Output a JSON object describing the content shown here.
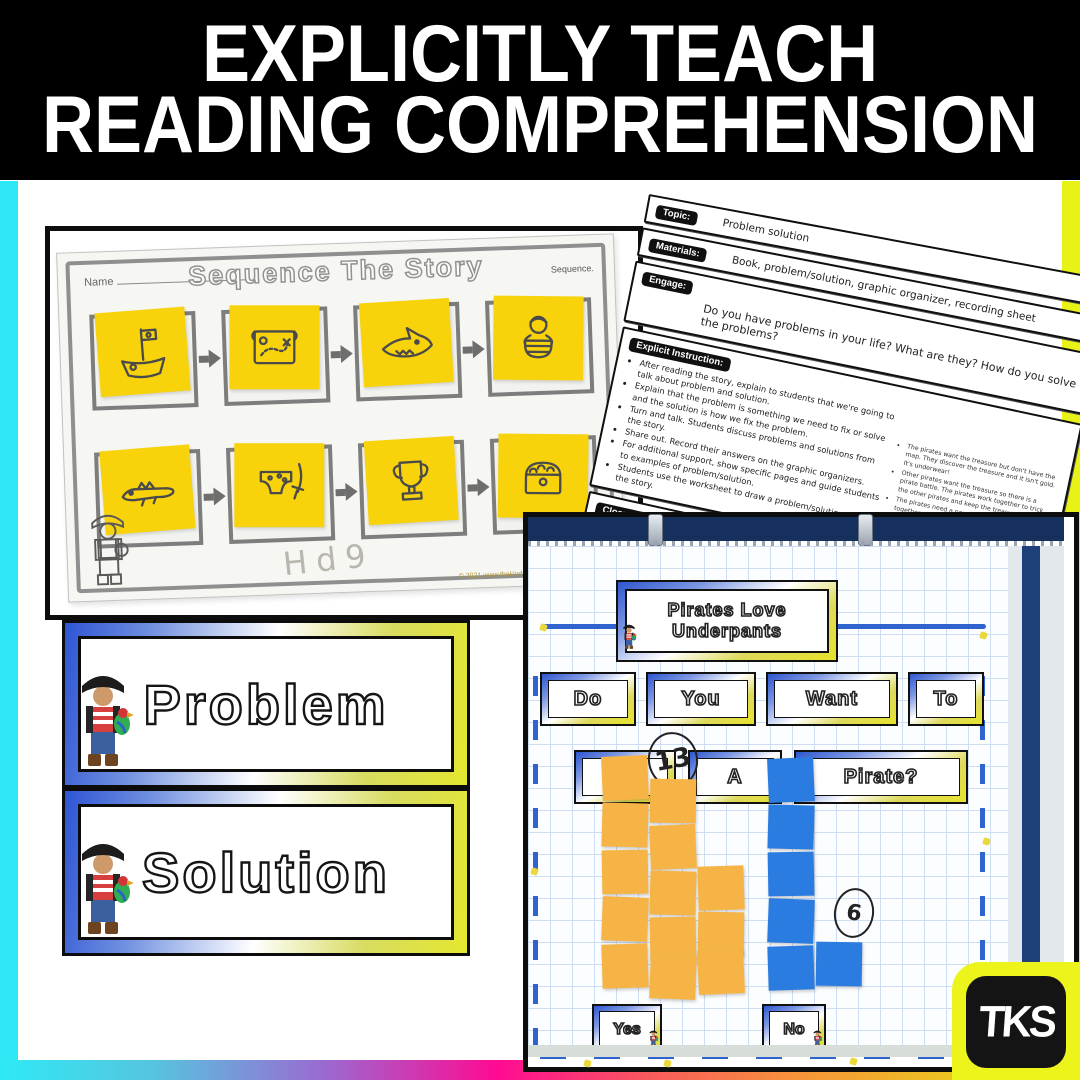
{
  "banner": {
    "line1": "EXPLICITLY TEACH",
    "line2": "READING COMPREHENSION",
    "background": "#000000",
    "text_color": "#ffffff"
  },
  "frame": {
    "left_color": "#2ee9f5",
    "right_color": "#e9f216",
    "bottom_gradient": [
      "#2ee9f5",
      "#56c5e0",
      "#9a6ad0",
      "#ff0a93",
      "#f85a5e",
      "#f7913c",
      "#edbd24",
      "#eaf216"
    ]
  },
  "worksheet": {
    "name_label": "Name",
    "title": "Sequence The Story",
    "corner_label": "Sequence.",
    "handwriting": "Hd9",
    "copyright": "© 2021 www.thekindergartensmorgasboard.com",
    "sticky_color": "#f8d30c",
    "sequence_icons_row1": [
      "pirate-ship-icon",
      "treasure-map-icon",
      "shark-icon",
      "pirate-in-boat-icon"
    ],
    "sequence_icons_row2": [
      "crocodile-icon",
      "underpants-sword-icon",
      "trophy-icon",
      "treasure-chest-icon"
    ]
  },
  "lesson_plan": {
    "sections": [
      {
        "label": "Topic:",
        "text": "Problem solution"
      },
      {
        "label": "Materials:",
        "text": "Book, problem/solution, graphic organizer, recording sheet"
      },
      {
        "label": "Engage:",
        "text": "Do you have problems in your life?  What are they?  How do you solve the problems?"
      },
      {
        "label": "Explicit Instruction:",
        "bullets": [
          "After reading the story, explain to students that we're going to talk about problem and solution.",
          "Explain that the problem is something we need to fix or solve and the solution is how we fix the problem.",
          "Turn and talk.  Students discuss problems and solutions from the story.",
          "Share out.  Record their answers on the graphic organizers.",
          "For additional support, show specific pages and guide students to examples of problem/solution.",
          "Students use the worksheet to draw a problem/solution from the story."
        ],
        "side_bullets": [
          "The pirates want the treasure but don't have the map.  They discover the treasure and it isn't gold.  It's underwear!",
          "Other pirates want the treasure so there is a pirate battle.  The pirates work together to trick the other pirates and keep the treasure.",
          "The pirates need a new sail for the ship.  They sew together giant underpants to make a sail.",
          "The pirates are sad when they realize they didn't get gold or jewels.  They are happy because they realize underpants are more fun!"
        ]
      },
      {
        "label": "Closure/Reflect:",
        "text": "Would you have solved the problems differently?"
      }
    ],
    "logo_text": "TKS",
    "footer": "(c) 2020 www.TheKindergartenSmorgasboard.com"
  },
  "cards": {
    "problem": "Problem",
    "solution": "Solution",
    "gradient": [
      "#2e55d4",
      "#ffffff",
      "#e4e72e"
    ]
  },
  "anchor_chart": {
    "title_line1": "Pirates Love",
    "title_line2": "Underpants",
    "question_row1": [
      "Do",
      "You",
      "Want",
      "To"
    ],
    "question_row2": [
      "Be",
      "A",
      "Pirate?"
    ],
    "yes_label": "Yes",
    "no_label": "No",
    "yes_count": 13,
    "no_count": 6,
    "yes_note_color": "#f5b445",
    "no_note_color": "#2b7ce0"
  },
  "logo": {
    "text": "TKS"
  },
  "chart_data": {
    "type": "bar",
    "title": "Do You Want To Be A Pirate?",
    "categories": [
      "Yes",
      "No"
    ],
    "values": [
      13,
      6
    ],
    "colors": [
      "#f5b445",
      "#2b7ce0"
    ],
    "ylabel": "",
    "note": "student votes shown as sticky notes stacked on grid chart paper"
  }
}
